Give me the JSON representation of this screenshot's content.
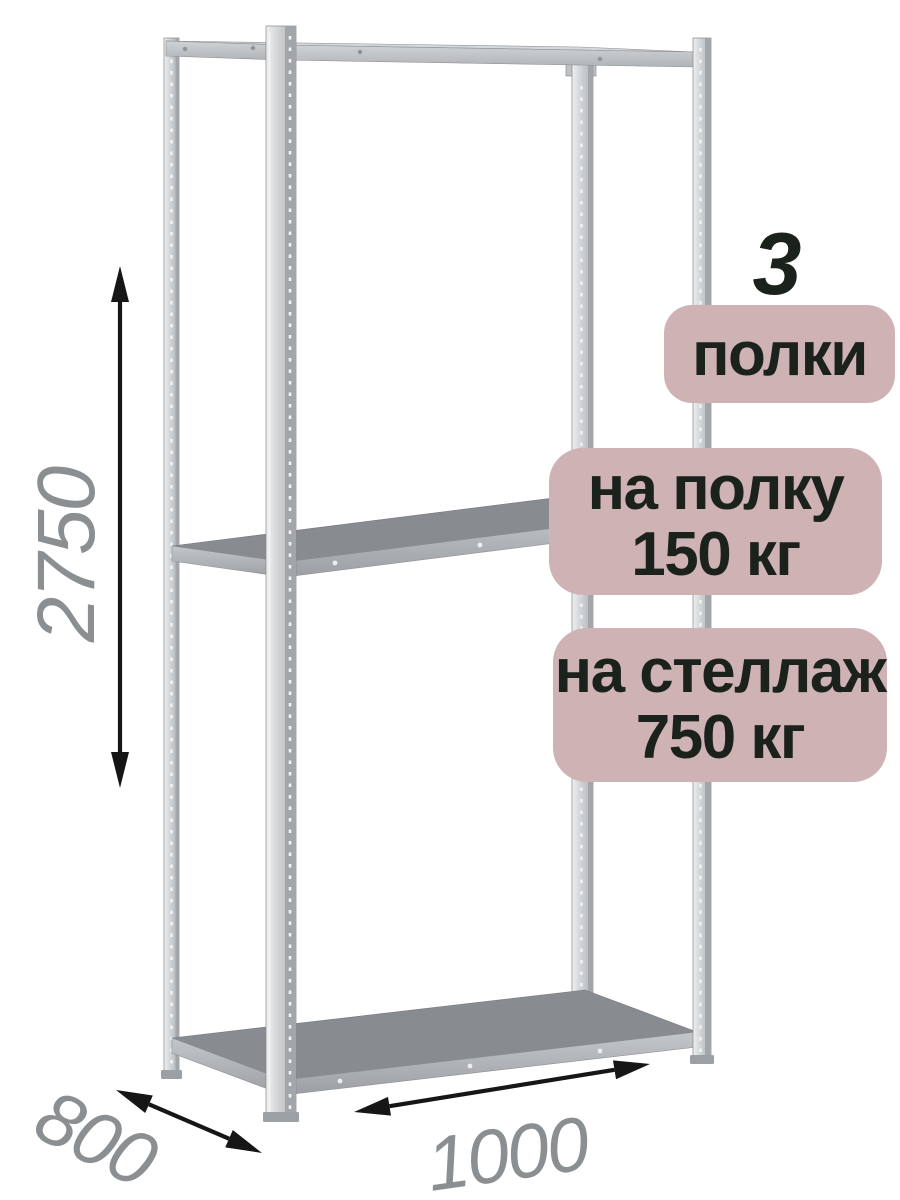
{
  "badges": {
    "count_value": "3",
    "count_label": "полки",
    "per_shelf": {
      "line1": "на полку",
      "line2": "150 кг"
    },
    "per_rack": {
      "line1": "на стеллаж",
      "line2": "750 кг"
    }
  },
  "dimensions": {
    "height_mm": "2750",
    "depth_mm": "800",
    "width_mm": "1000"
  },
  "illustration": {
    "subject": "metal-shelving-rack",
    "shelf_count": 3,
    "post_count": 4
  },
  "colors": {
    "background": "#ffffff",
    "badge_bg": "#ceb2b4",
    "badge_text": "#1b211b",
    "dimension_text": "#8b8f91",
    "arrow": "#161616",
    "metal_face_light": "#eef0f1",
    "metal_face_mid": "#c6c9cc",
    "metal_side_dark": "#a2a6aa",
    "shelf_top_dark": "#888c90"
  }
}
